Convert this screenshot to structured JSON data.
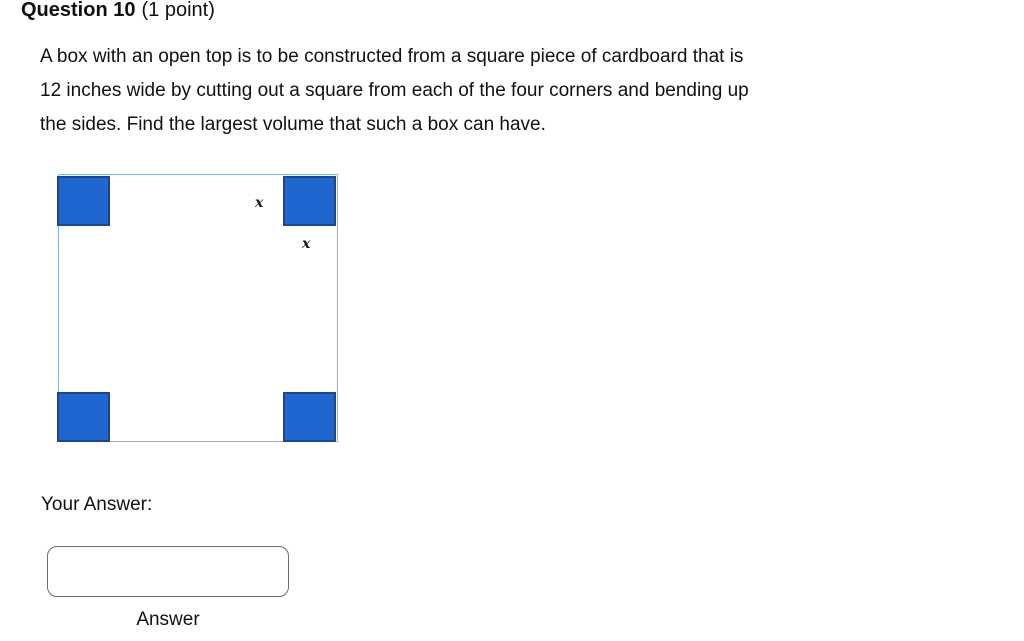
{
  "question": {
    "number_label": "Question 10",
    "points_label": "(1 point)",
    "body_lines": [
      "A box with an open top is to be constructed from a square piece of cardboard that is",
      "12 inches wide by cutting out a square from each of the four corners and bending up",
      "the sides. Find the largest volume that such a box can have."
    ]
  },
  "figure": {
    "description": "square cardboard with blue cutout squares at each corner",
    "corner_label": "x",
    "colors": {
      "cutout_fill": "#1f66d0",
      "cutout_border": "#1b4693",
      "outline": "#8ab4d8"
    }
  },
  "answer": {
    "prompt": "Your Answer:",
    "input_value": "",
    "label": "Answer"
  }
}
